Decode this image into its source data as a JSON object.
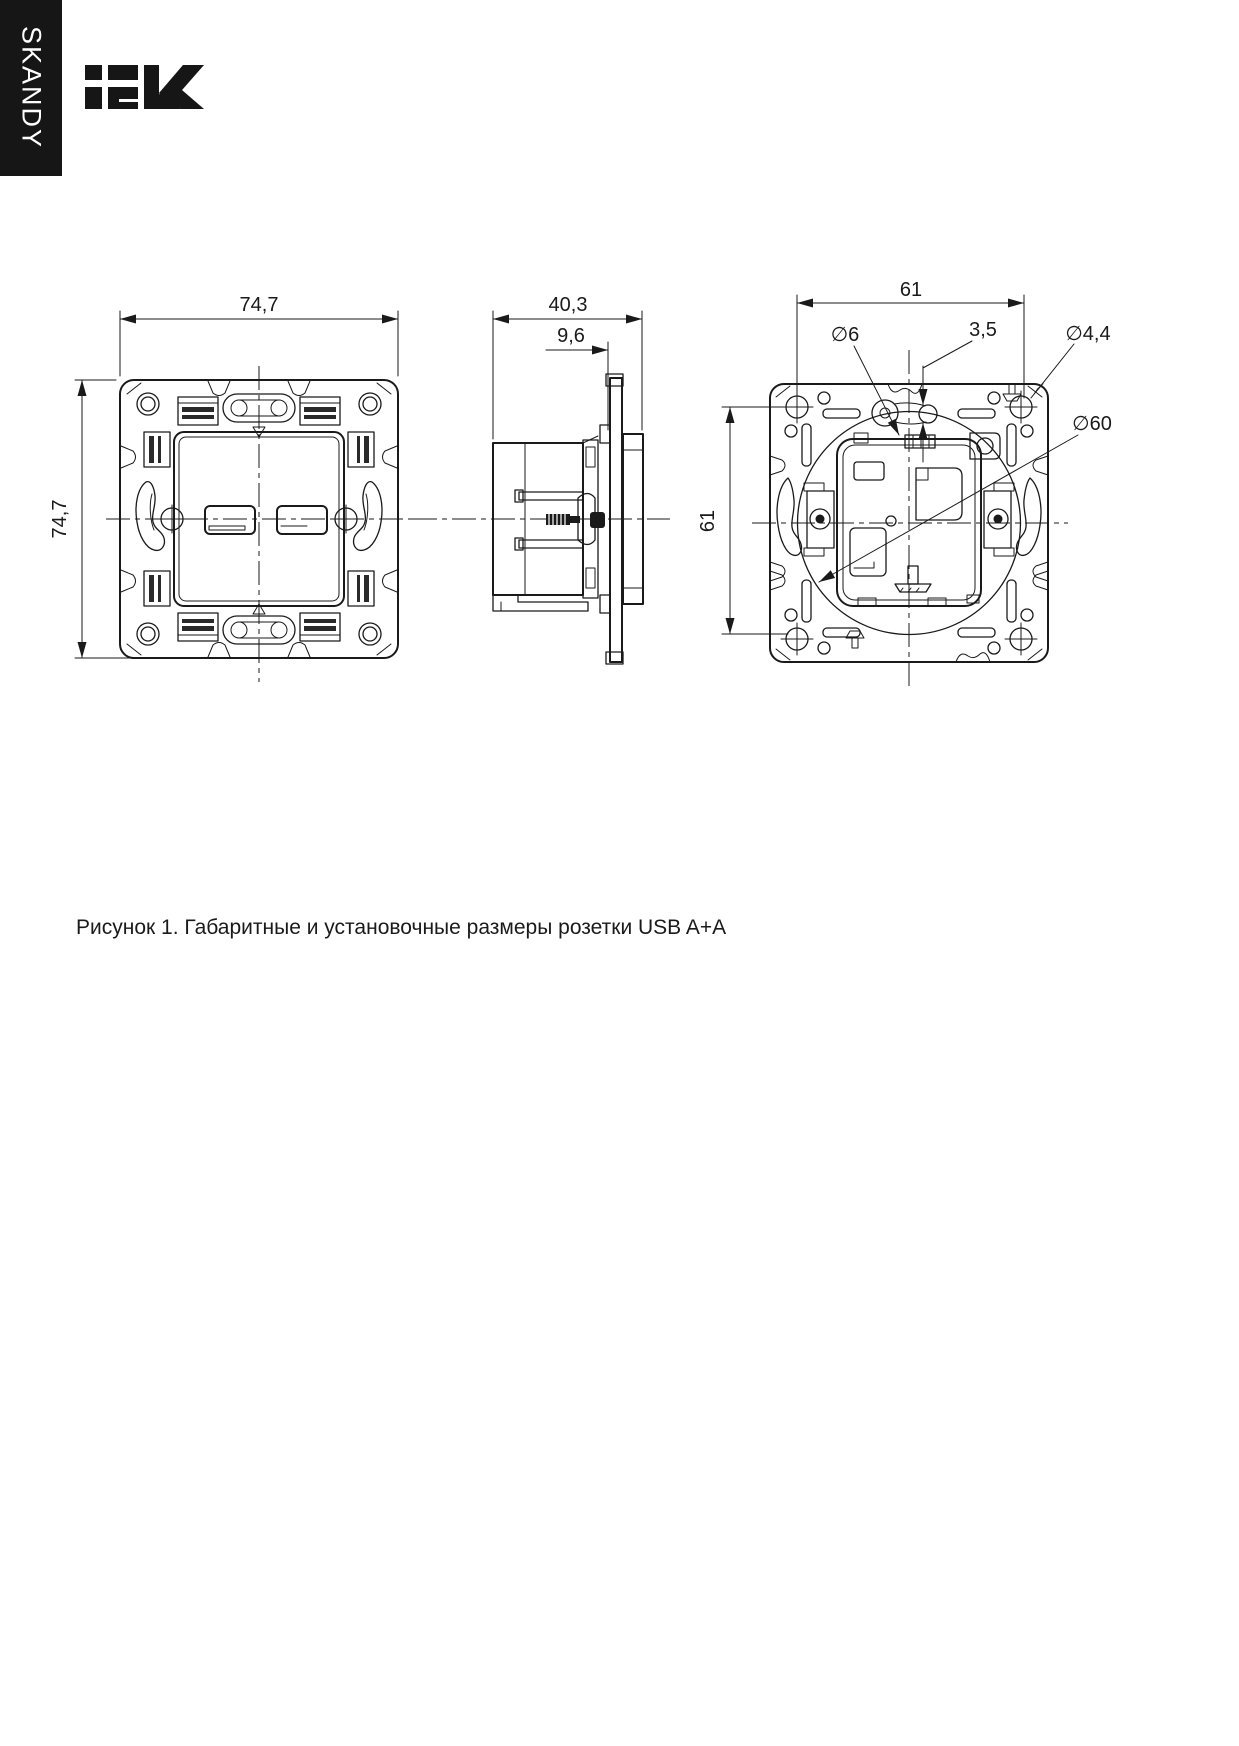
{
  "brand": {
    "vertical_label": "SKANDY",
    "logo_text": "IEK"
  },
  "figure": {
    "front": {
      "width": "74,7",
      "height": "74,7"
    },
    "side": {
      "depth": "40,3",
      "front_offset": "9,6"
    },
    "back": {
      "hole_spacing_width": "61",
      "hole_spacing_height": "61",
      "slot_diameter": "∅6",
      "bridge_thickness": "3,5",
      "screw_hole_diameter": "∅4,4",
      "support_circle_diameter": "∅60"
    }
  },
  "caption": "Рисунок 1. Габаритные и установочные размеры розетки USB A+A"
}
